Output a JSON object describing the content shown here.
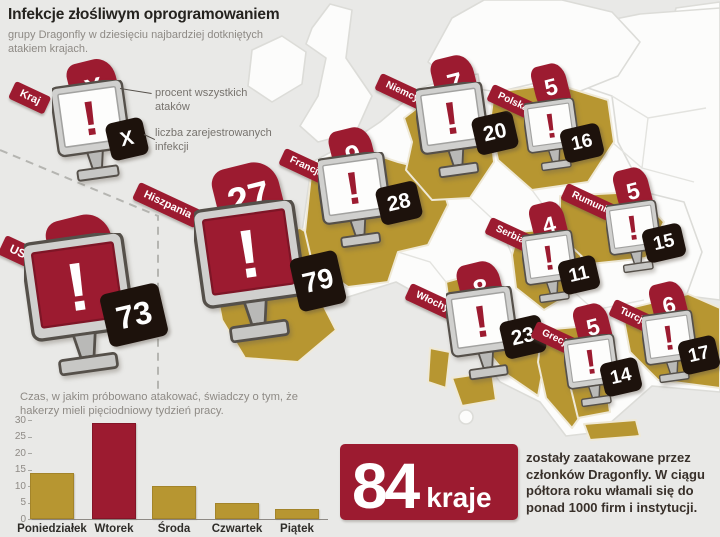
{
  "header": {
    "title": "Infekcje złośliwym oprogramowaniem",
    "subtitle": "grupy Dragonfly w dziesięciu najbardziej dotkniętych atakiem krajach."
  },
  "legend": {
    "country_label": "Kraj",
    "percent_symbol": "X",
    "count_symbol": "X",
    "percent_caption": "procent wszystkich ataków",
    "count_caption": "liczba zarejestrowanych infekcji"
  },
  "map": {
    "countries": [
      {
        "id": "usa",
        "name": "USA",
        "percent": 24,
        "infections": 73,
        "screen": "red"
      },
      {
        "id": "hiszpania",
        "name": "Hiszpania",
        "percent": 27,
        "infections": 79,
        "screen": "red"
      },
      {
        "id": "francja",
        "name": "Francja",
        "percent": 9,
        "infections": 28,
        "screen": "white"
      },
      {
        "id": "niemcy",
        "name": "Niemcy",
        "percent": 7,
        "infections": 20,
        "screen": "white"
      },
      {
        "id": "polska",
        "name": "Polska",
        "percent": 5,
        "infections": 16,
        "screen": "white"
      },
      {
        "id": "rumunia",
        "name": "Rumunia",
        "percent": 5,
        "infections": 15,
        "screen": "white"
      },
      {
        "id": "serbia",
        "name": "Serbia",
        "percent": 4,
        "infections": 11,
        "screen": "white"
      },
      {
        "id": "wlochy",
        "name": "Włochy",
        "percent": 8,
        "infections": 23,
        "screen": "white"
      },
      {
        "id": "grecja",
        "name": "Grecja",
        "percent": 5,
        "infections": 14,
        "screen": "white"
      },
      {
        "id": "turcja",
        "name": "Turcja",
        "percent": 6,
        "infections": 17,
        "screen": "white"
      }
    ]
  },
  "chart_note": "Czas, w jakim próbowano atakować, świadczy o tym, że hakerzy mieli pięciodniowy tydzień pracy.",
  "chart_data": [
    {
      "type": "bar",
      "categories": [
        "Poniedziałek",
        "Wtorek",
        "Środa",
        "Czwartek",
        "Piątek"
      ],
      "values": [
        14,
        29,
        10,
        5,
        3
      ],
      "highlight_index": 1,
      "title": "Czas, w jakim próbowano atakować, świadczy o tym, że hakerzy mieli pięciodniowy tydzień pracy.",
      "xlabel": "",
      "ylabel": "",
      "ylim": [
        0,
        30
      ],
      "yticks": [
        0,
        5,
        10,
        15,
        20,
        25,
        30
      ],
      "grid": false,
      "legend": false,
      "bar_color": "#b79631",
      "highlight_color": "#9c1b30"
    },
    {
      "type": "table",
      "title": "Infekcje złośliwym oprogramowaniem grupy Dragonfly w dziesięciu najbardziej dotkniętych atakiem krajach",
      "columns": [
        "Kraj",
        "procent wszystkich ataków",
        "liczba zarejestrowanych infekcji"
      ],
      "rows": [
        [
          "USA",
          24,
          73
        ],
        [
          "Hiszpania",
          27,
          79
        ],
        [
          "Francja",
          9,
          28
        ],
        [
          "Niemcy",
          7,
          20
        ],
        [
          "Polska",
          5,
          16
        ],
        [
          "Rumunia",
          5,
          15
        ],
        [
          "Serbia",
          4,
          11
        ],
        [
          "Włochy",
          8,
          23
        ],
        [
          "Grecja",
          5,
          14
        ],
        [
          "Turcja",
          6,
          17
        ]
      ]
    }
  ],
  "summary": {
    "number": "84",
    "unit": "kraje",
    "text": "zostały zaatakowane przez członków Dragonfly. W ciągu półtora roku włamali się do ponad 1000 firm i instytucji."
  },
  "colors": {
    "red": "#9c1b30",
    "gold": "#b79631",
    "dark": "#1d120c",
    "background": "#e9e9e7"
  }
}
